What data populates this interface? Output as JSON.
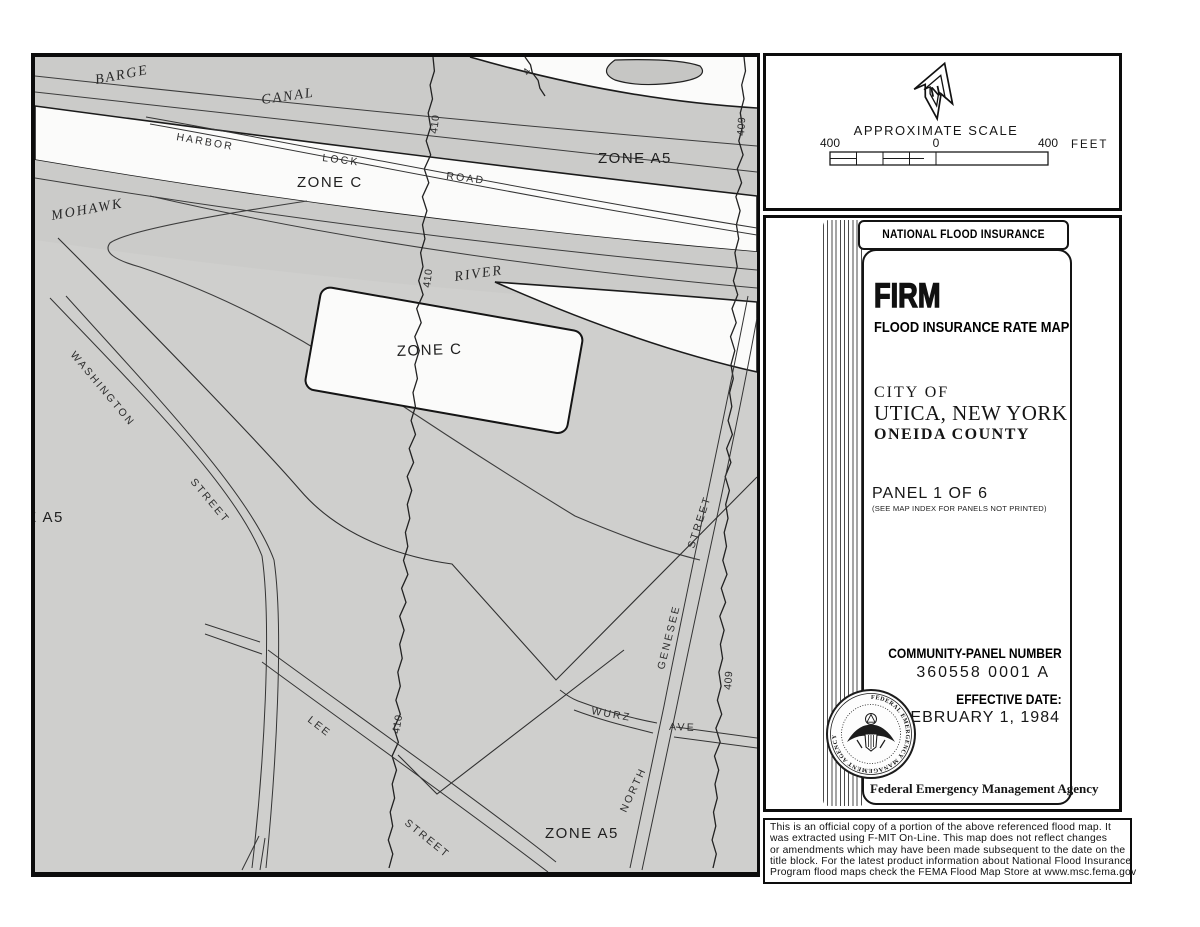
{
  "map": {
    "colors": {
      "paper": "#cfcfcd",
      "band_gray": "#cbcbc9",
      "white": "#fbfbfa",
      "line": "#343434",
      "outline": "#1b1b1b"
    },
    "labels": [
      {
        "name": "barge",
        "text": "BARGE"
      },
      {
        "name": "canal",
        "text": "CANAL"
      },
      {
        "name": "mohawk",
        "text": "MOHAWK"
      },
      {
        "name": "river",
        "text": "RIVER"
      },
      {
        "name": "harbor",
        "text": "HARBOR"
      },
      {
        "name": "lock",
        "text": "LOCK"
      },
      {
        "name": "road",
        "text": "ROAD"
      },
      {
        "name": "zone-a5-top",
        "text": "ZONE A5"
      },
      {
        "name": "zone-c-corridor",
        "text": "ZONE C"
      },
      {
        "name": "zone-c-island",
        "text": "ZONE C"
      },
      {
        "name": "zone-a5-left",
        "text": "ZONE A5"
      },
      {
        "name": "zone-a5-bottom",
        "text": "ZONE A5"
      },
      {
        "name": "washington",
        "text": "WASHINGTON"
      },
      {
        "name": "washington-street",
        "text": "STREET"
      },
      {
        "name": "lee",
        "text": "LEE"
      },
      {
        "name": "lee-street",
        "text": "STREET"
      },
      {
        "name": "wurz",
        "text": "WURZ"
      },
      {
        "name": "ave",
        "text": "AVE"
      },
      {
        "name": "north",
        "text": "NORTH"
      },
      {
        "name": "genesee",
        "text": "GENESEE"
      },
      {
        "name": "genesee-street",
        "text": "STREET"
      },
      {
        "name": "contour-410-top",
        "text": "410"
      },
      {
        "name": "contour-410-mid",
        "text": "410"
      },
      {
        "name": "contour-410-low",
        "text": "410"
      },
      {
        "name": "contour-409-top",
        "text": "409"
      },
      {
        "name": "contour-409-low",
        "text": "409"
      },
      {
        "name": "contour-partial",
        "text": "4"
      }
    ]
  },
  "scale_panel": {
    "north_letter": "N",
    "title": "APPROXIMATE SCALE",
    "left_value": "400",
    "zero_value": "0",
    "right_value": "400",
    "unit": "FEET"
  },
  "title_block": {
    "program": "NATIONAL FLOOD INSURANCE PROGRAM",
    "firm": "FIRM",
    "firm_subtitle": "FLOOD INSURANCE RATE MAP",
    "community_line1": "CITY OF",
    "community_line2": "UTICA, NEW YORK",
    "community_line3": "ONEIDA COUNTY",
    "panel": "PANEL 1 OF 6",
    "panel_note": "(SEE MAP INDEX FOR PANELS NOT PRINTED)",
    "community_panel_label": "COMMUNITY-PANEL NUMBER",
    "community_panel_number": "360558 0001 A",
    "effective_date_label": "EFFECTIVE DATE:",
    "effective_date_value": "FEBRUARY 1, 1984",
    "agency": "Federal Emergency Management Agency",
    "seal_text": "FEDERAL EMERGENCY MANAGEMENT AGENCY"
  },
  "disclaimer": {
    "lines": [
      "This is an official copy of a portion of the above referenced flood map.  It",
      "was extracted using F-MIT On-Line.  This map does not reflect changes",
      "or amendments which may have been made subsequent to the date on the",
      "title block.   For the latest product information about National Flood Insurance",
      "Program flood maps check the FEMA Flood Map Store at www.msc.fema.gov"
    ]
  }
}
